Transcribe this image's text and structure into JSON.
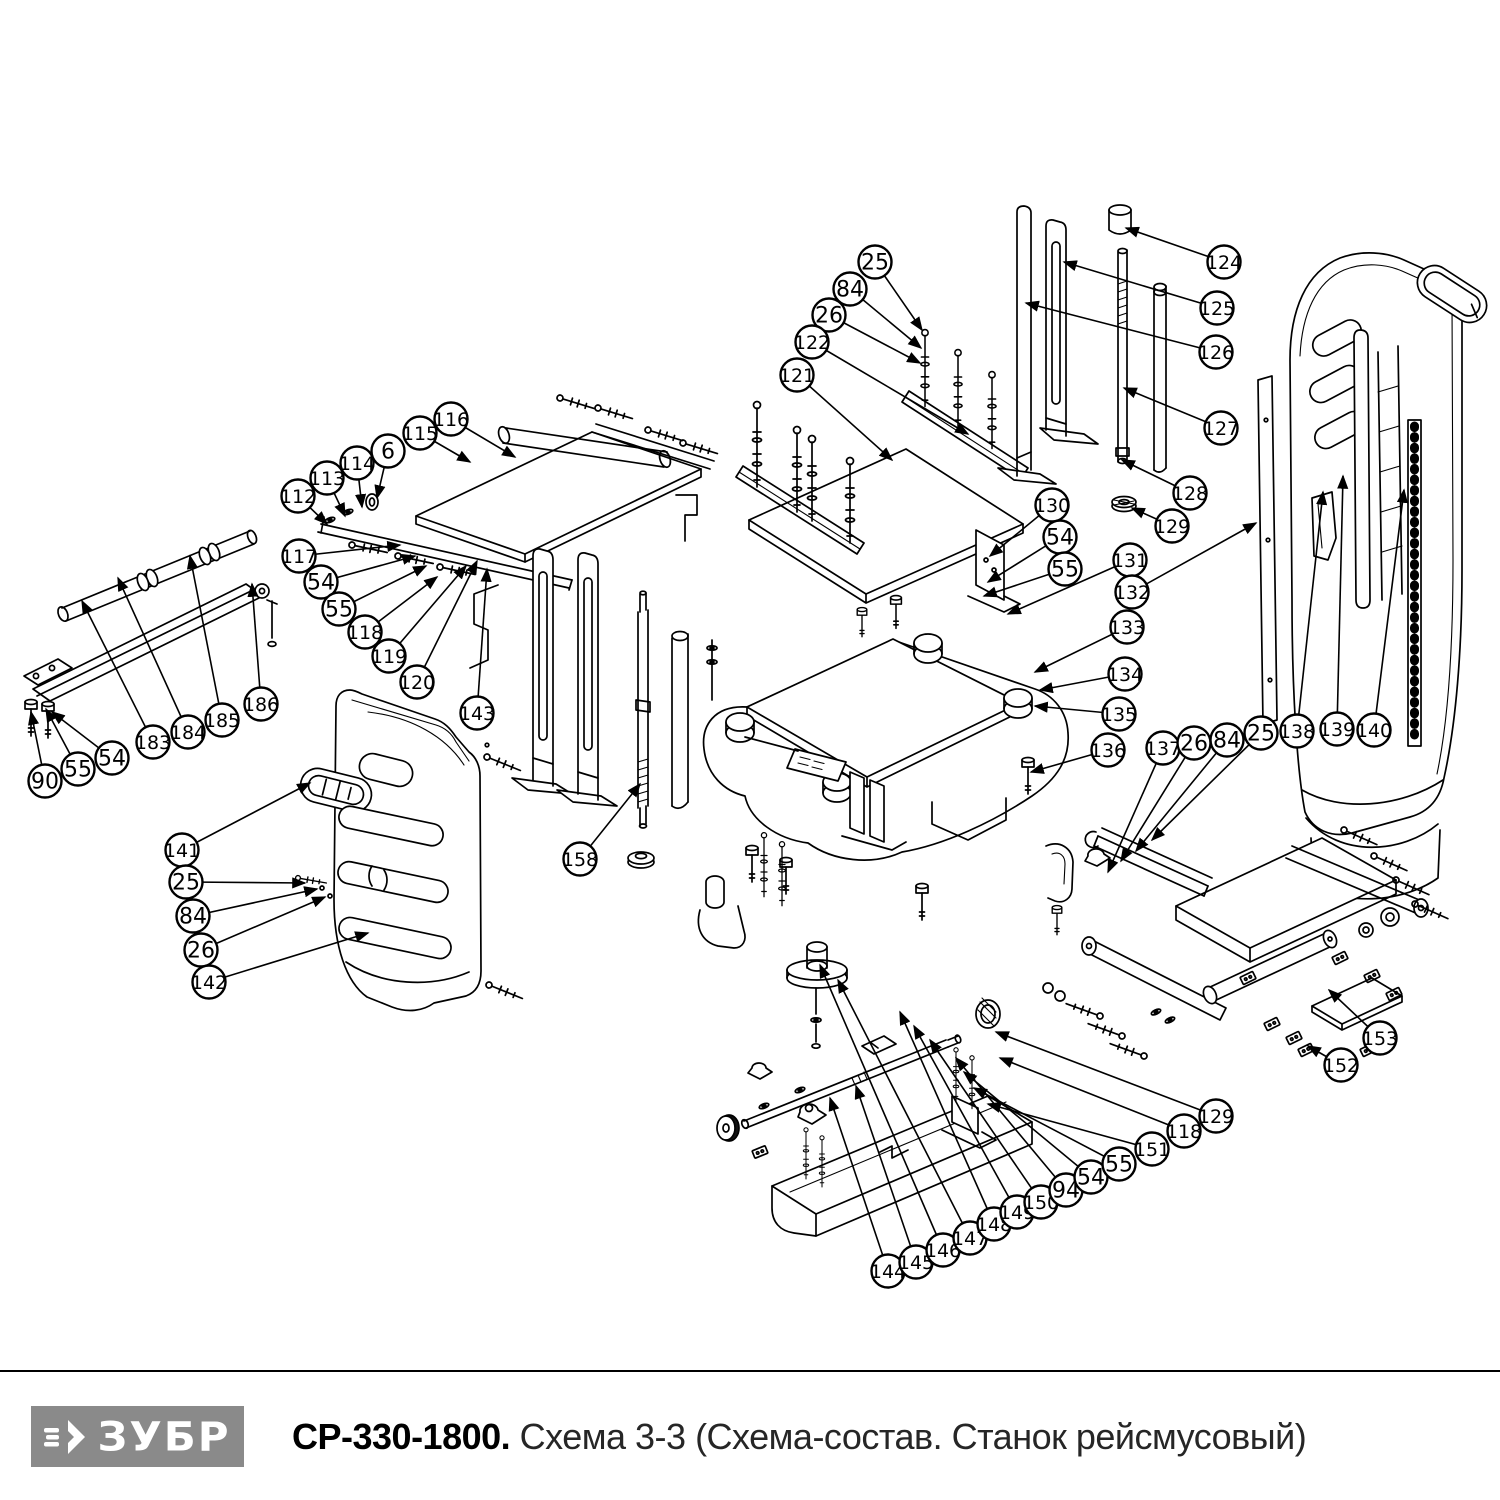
{
  "footer": {
    "separator_color": "#000000",
    "logo": {
      "text": "ЗУБР",
      "bg": "#8a8a8a",
      "fg": "#ffffff"
    },
    "title": {
      "model": "СР-330-1800.",
      "description": " Схема 3-3 (Схема-состав. Станок рейсмусовый)"
    }
  },
  "diagram": {
    "line_color": "#000000",
    "balloon_style": {
      "radius": 16.5,
      "fill": "#ffffff",
      "stroke": "#000000",
      "stroke_width": 2.4,
      "font_size_2digit": 22,
      "font_size_3digit": 19
    },
    "balloons": [
      {
        "n": "116",
        "x": 451,
        "y": 419,
        "tx": 515,
        "ty": 457
      },
      {
        "n": "115",
        "x": 420,
        "y": 433,
        "tx": 470,
        "ty": 462
      },
      {
        "n": "6",
        "x": 388,
        "y": 451,
        "tx": 377,
        "ty": 498
      },
      {
        "n": "114",
        "x": 357,
        "y": 463,
        "tx": 362,
        "ty": 507
      },
      {
        "n": "113",
        "x": 327,
        "y": 478,
        "tx": 345,
        "ty": 516
      },
      {
        "n": "112",
        "x": 298,
        "y": 496,
        "tx": 327,
        "ty": 524
      },
      {
        "n": "117",
        "x": 299,
        "y": 556,
        "tx": 400,
        "ty": 545
      },
      {
        "n": "54",
        "x": 321,
        "y": 582,
        "tx": 415,
        "ty": 556
      },
      {
        "n": "55",
        "x": 339,
        "y": 609,
        "tx": 426,
        "ty": 566
      },
      {
        "n": "118",
        "x": 365,
        "y": 632,
        "tx": 437,
        "ty": 577
      },
      {
        "n": "119",
        "x": 389,
        "y": 656,
        "tx": 466,
        "ty": 566
      },
      {
        "n": "120",
        "x": 417,
        "y": 682,
        "tx": 477,
        "ty": 561
      },
      {
        "n": "143",
        "x": 477,
        "y": 713,
        "tx": 487,
        "ty": 569
      },
      {
        "n": "90",
        "x": 45,
        "y": 781,
        "tx": 31,
        "ty": 712
      },
      {
        "n": "55",
        "x": 78,
        "y": 769,
        "tx": 46,
        "ty": 709
      },
      {
        "n": "54",
        "x": 112,
        "y": 758,
        "tx": 52,
        "ty": 712
      },
      {
        "n": "183",
        "x": 153,
        "y": 742,
        "tx": 82,
        "ty": 601
      },
      {
        "n": "184",
        "x": 188,
        "y": 732,
        "tx": 118,
        "ty": 578
      },
      {
        "n": "185",
        "x": 222,
        "y": 720,
        "tx": 190,
        "ty": 556
      },
      {
        "n": "186",
        "x": 261,
        "y": 704,
        "tx": 252,
        "ty": 584
      },
      {
        "n": "141",
        "x": 182,
        "y": 850,
        "tx": 310,
        "ty": 783
      },
      {
        "n": "25",
        "x": 186,
        "y": 882,
        "tx": 305,
        "ty": 883
      },
      {
        "n": "84",
        "x": 193,
        "y": 916,
        "tx": 317,
        "ty": 889
      },
      {
        "n": "26",
        "x": 201,
        "y": 950,
        "tx": 325,
        "ty": 897
      },
      {
        "n": "142",
        "x": 209,
        "y": 982,
        "tx": 368,
        "ty": 933
      },
      {
        "n": "158",
        "x": 580,
        "y": 859,
        "tx": 640,
        "ty": 784
      },
      {
        "n": "25",
        "x": 875,
        "y": 262,
        "tx": 922,
        "ty": 330
      },
      {
        "n": "84",
        "x": 850,
        "y": 289,
        "tx": 921,
        "ty": 348
      },
      {
        "n": "26",
        "x": 829,
        "y": 315,
        "tx": 920,
        "ty": 363
      },
      {
        "n": "122",
        "x": 812,
        "y": 342,
        "tx": 968,
        "ty": 434
      },
      {
        "n": "121",
        "x": 797,
        "y": 375,
        "tx": 892,
        "ty": 460
      },
      {
        "n": "124",
        "x": 1224,
        "y": 262,
        "tx": 1126,
        "ty": 228
      },
      {
        "n": "125",
        "x": 1217,
        "y": 308,
        "tx": 1064,
        "ty": 262
      },
      {
        "n": "126",
        "x": 1216,
        "y": 352,
        "tx": 1026,
        "ty": 303
      },
      {
        "n": "127",
        "x": 1221,
        "y": 428,
        "tx": 1124,
        "ty": 388
      },
      {
        "n": "128",
        "x": 1190,
        "y": 493,
        "tx": 1122,
        "ty": 460
      },
      {
        "n": "129",
        "x": 1172,
        "y": 526,
        "tx": 1132,
        "ty": 508
      },
      {
        "n": "130",
        "x": 1052,
        "y": 505,
        "tx": 990,
        "ty": 556
      },
      {
        "n": "54",
        "x": 1060,
        "y": 537,
        "tx": 988,
        "ty": 582
      },
      {
        "n": "55",
        "x": 1065,
        "y": 569,
        "tx": 984,
        "ty": 596
      },
      {
        "n": "131",
        "x": 1130,
        "y": 560,
        "tx": 1008,
        "ty": 614
      },
      {
        "n": "132",
        "x": 1132,
        "y": 592,
        "tx": 1256,
        "ty": 523
      },
      {
        "n": "133",
        "x": 1127,
        "y": 627,
        "tx": 1035,
        "ty": 672
      },
      {
        "n": "134",
        "x": 1125,
        "y": 674,
        "tx": 1040,
        "ty": 690
      },
      {
        "n": "135",
        "x": 1119,
        "y": 714,
        "tx": 1035,
        "ty": 706
      },
      {
        "n": "136",
        "x": 1108,
        "y": 750,
        "tx": 1031,
        "ty": 772
      },
      {
        "n": "137",
        "x": 1163,
        "y": 748,
        "tx": 1108,
        "ty": 872
      },
      {
        "n": "26",
        "x": 1194,
        "y": 743,
        "tx": 1121,
        "ty": 861
      },
      {
        "n": "84",
        "x": 1227,
        "y": 740,
        "tx": 1136,
        "ty": 851
      },
      {
        "n": "25",
        "x": 1261,
        "y": 733,
        "tx": 1152,
        "ty": 840
      },
      {
        "n": "138",
        "x": 1297,
        "y": 731,
        "tx": 1323,
        "ty": 492
      },
      {
        "n": "139",
        "x": 1337,
        "y": 729,
        "tx": 1343,
        "ty": 476
      },
      {
        "n": "140",
        "x": 1374,
        "y": 730,
        "tx": 1404,
        "ty": 490
      },
      {
        "n": "144",
        "x": 888,
        "y": 1271,
        "tx": 830,
        "ty": 1098
      },
      {
        "n": "145",
        "x": 916,
        "y": 1262,
        "tx": 856,
        "ty": 1086
      },
      {
        "n": "146",
        "x": 943,
        "y": 1250,
        "tx": 820,
        "ty": 965
      },
      {
        "n": "147",
        "x": 970,
        "y": 1238,
        "tx": 838,
        "ty": 980
      },
      {
        "n": "148",
        "x": 994,
        "y": 1224,
        "tx": 900,
        "ty": 1012
      },
      {
        "n": "149",
        "x": 1017,
        "y": 1212,
        "tx": 914,
        "ty": 1026
      },
      {
        "n": "150",
        "x": 1041,
        "y": 1202,
        "tx": 930,
        "ty": 1040
      },
      {
        "n": "94",
        "x": 1066,
        "y": 1190,
        "tx": 956,
        "ty": 1058
      },
      {
        "n": "54",
        "x": 1091,
        "y": 1177,
        "tx": 964,
        "ty": 1072
      },
      {
        "n": "55",
        "x": 1119,
        "y": 1164,
        "tx": 974,
        "ty": 1088
      },
      {
        "n": "151",
        "x": 1152,
        "y": 1149,
        "tx": 988,
        "ty": 1104
      },
      {
        "n": "118",
        "x": 1184,
        "y": 1131,
        "tx": 1000,
        "ty": 1058
      },
      {
        "n": "129",
        "x": 1216,
        "y": 1116,
        "tx": 996,
        "ty": 1032
      },
      {
        "n": "152",
        "x": 1341,
        "y": 1065,
        "tx": 1308,
        "ty": 1046
      },
      {
        "n": "153",
        "x": 1380,
        "y": 1038,
        "tx": 1329,
        "ty": 990
      }
    ]
  }
}
